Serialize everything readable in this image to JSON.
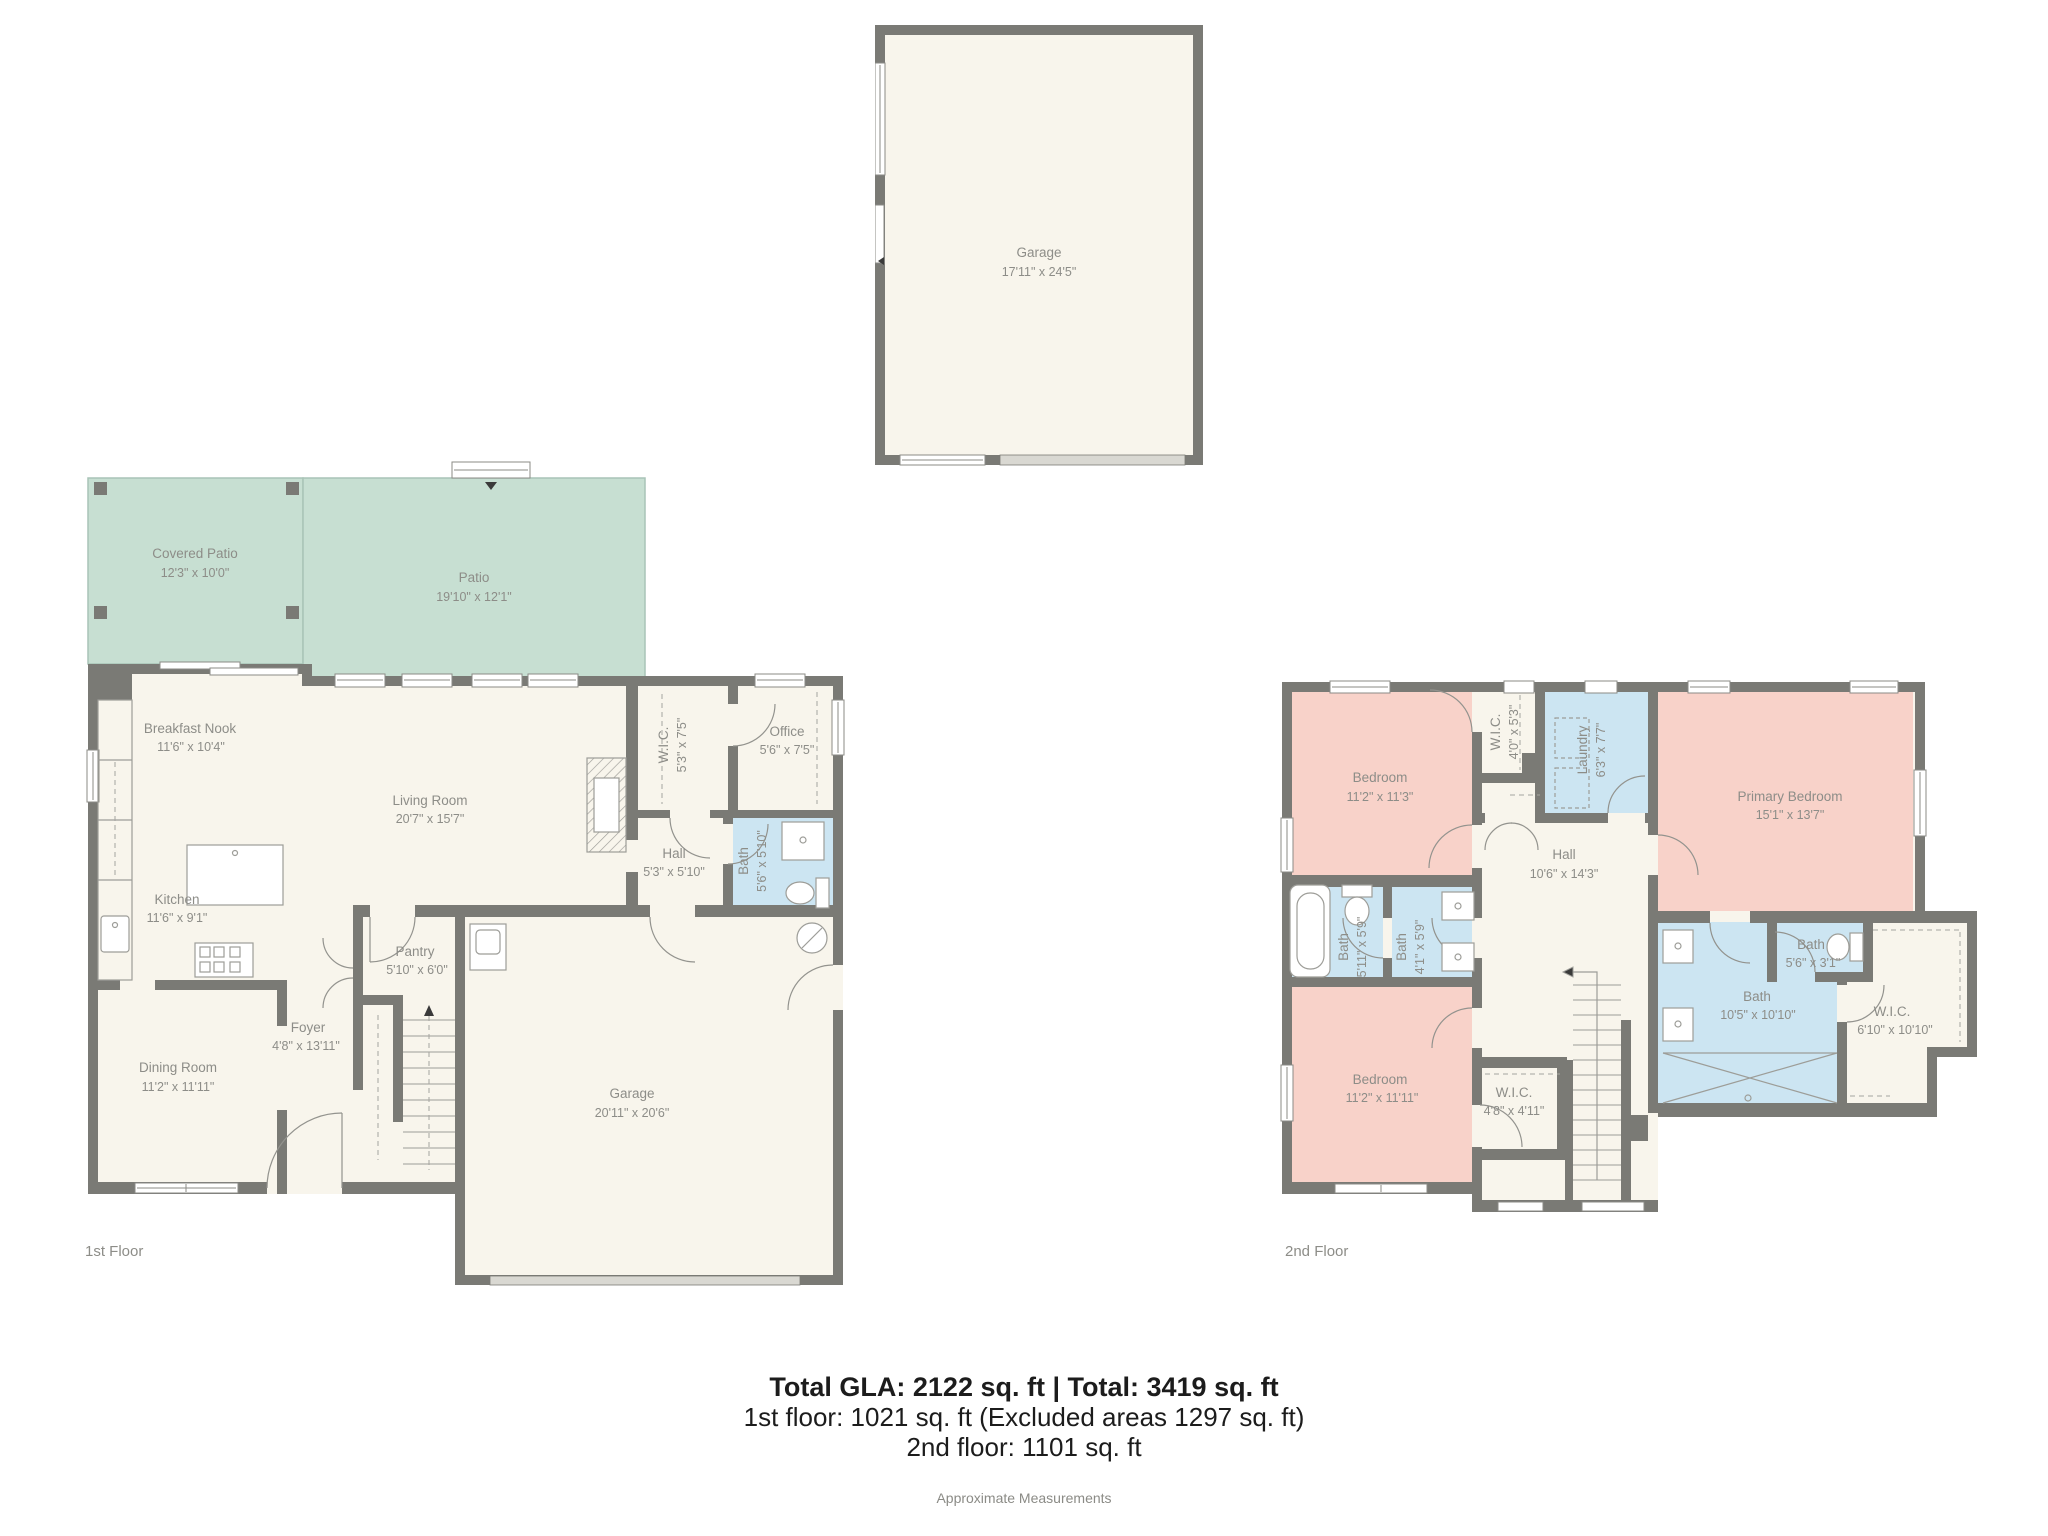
{
  "footer": {
    "line1": "Total GLA: 2122 sq. ft | Total: 3419 sq. ft",
    "line2": "1st floor: 1021 sq. ft (Excluded areas 1297 sq. ft)",
    "line3": "2nd floor: 1101 sq. ft",
    "note": "Approximate Measurements"
  },
  "floor_labels": {
    "first": "1st Floor",
    "second": "2nd Floor"
  },
  "detached_garage": {
    "name": "Garage",
    "dims": "17'11\" x 24'5\""
  },
  "floor1": {
    "rooms": [
      {
        "name": "Covered Patio",
        "dims": "12'3\" x 10'0\""
      },
      {
        "name": "Patio",
        "dims": "19'10\" x 12'1\""
      },
      {
        "name": "Breakfast Nook",
        "dims": "11'6\" x 10'4\""
      },
      {
        "name": "Living Room",
        "dims": "20'7\" x 15'7\""
      },
      {
        "name": "Kitchen",
        "dims": "11'6\" x 9'1\""
      },
      {
        "name": "W.I.C.",
        "dims": "5'3\" x 7'5\""
      },
      {
        "name": "Office",
        "dims": "5'6\" x 7'5\""
      },
      {
        "name": "Hall",
        "dims": "5'3\" x 5'10\""
      },
      {
        "name": "Bath",
        "dims": "5'6\" x 5'10\""
      },
      {
        "name": "Pantry",
        "dims": "5'10\" x 6'0\""
      },
      {
        "name": "Foyer",
        "dims": "4'8\" x 13'11\""
      },
      {
        "name": "Dining Room",
        "dims": "11'2\" x 11'11\""
      },
      {
        "name": "Garage",
        "dims": "20'11\" x 20'6\""
      }
    ]
  },
  "floor2": {
    "rooms": [
      {
        "name": "Bedroom",
        "dims": "11'2\" x 11'3\""
      },
      {
        "name": "W.I.C.",
        "dims": "4'0\" x 5'3\""
      },
      {
        "name": "Laundry",
        "dims": "6'3\" x 7'7\""
      },
      {
        "name": "Primary Bedroom",
        "dims": "15'1\" x 13'7\""
      },
      {
        "name": "Hall",
        "dims": "10'6\" x 14'3\""
      },
      {
        "name": "Bath",
        "dims": "5'11\" x 5'9\""
      },
      {
        "name": "Bath",
        "dims": "4'1\" x 5'9\""
      },
      {
        "name": "Bedroom",
        "dims": "11'2\" x 11'11\""
      },
      {
        "name": "W.I.C.",
        "dims": "4'8\" x 4'11\""
      },
      {
        "name": "Bath",
        "dims": "10'5\" x 10'10\""
      },
      {
        "name": "Bath",
        "dims": "5'6\" x 3'1\""
      },
      {
        "name": "W.I.C.",
        "dims": "6'10\" x 10'10\""
      }
    ]
  },
  "colors": {
    "wall": "#7a7a75",
    "floor": "#f8f5ec",
    "patio": "#c7dfd2",
    "bedroom": "#f8d2c9",
    "bath": "#cce5f2",
    "garage_door": "#d9d8d2"
  }
}
